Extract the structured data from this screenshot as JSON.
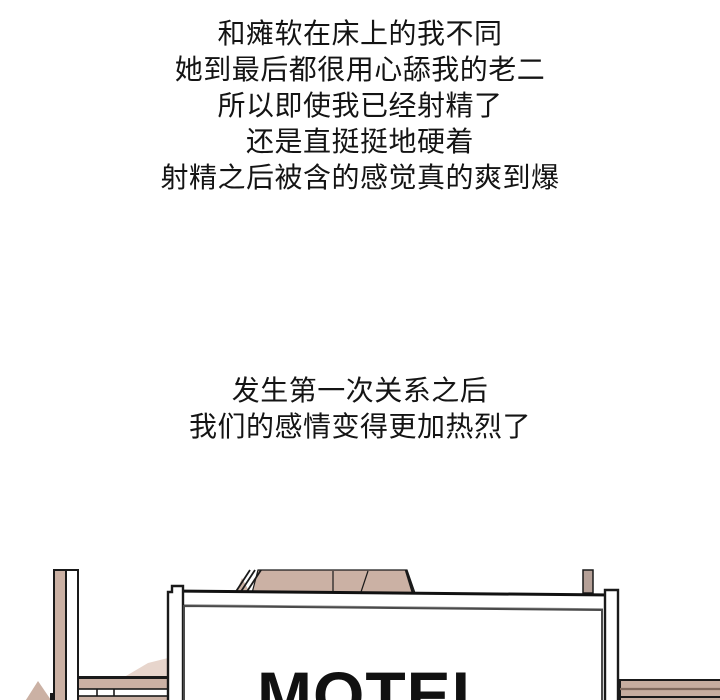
{
  "page": {
    "background": "#ffffff"
  },
  "narration_top": {
    "lines": [
      "和瘫软在床上的我不同",
      "她到最后都很用心舔我的老二",
      "所以即使我已经射精了",
      "还是直挺挺地硬着",
      "射精之后被含的感觉真的爽到爆"
    ]
  },
  "narration_middle": {
    "lines": [
      "发生第一次关系之后",
      "我们的感情变得更加热烈了"
    ]
  },
  "illustration": {
    "sign_text": "MOTEL",
    "colors": {
      "outline": "#1a1a1a",
      "tan": "#cbb1a4",
      "tan_light": "#e7d5cc",
      "tan_gray": "#b5a097",
      "slab": "#c6ad9f",
      "slab_line": "#806a5e",
      "bar_shadow": "#8f8f8f",
      "panel_border": "#4a4a4a",
      "sign_text_color": "#111111",
      "white": "#ffffff"
    }
  }
}
